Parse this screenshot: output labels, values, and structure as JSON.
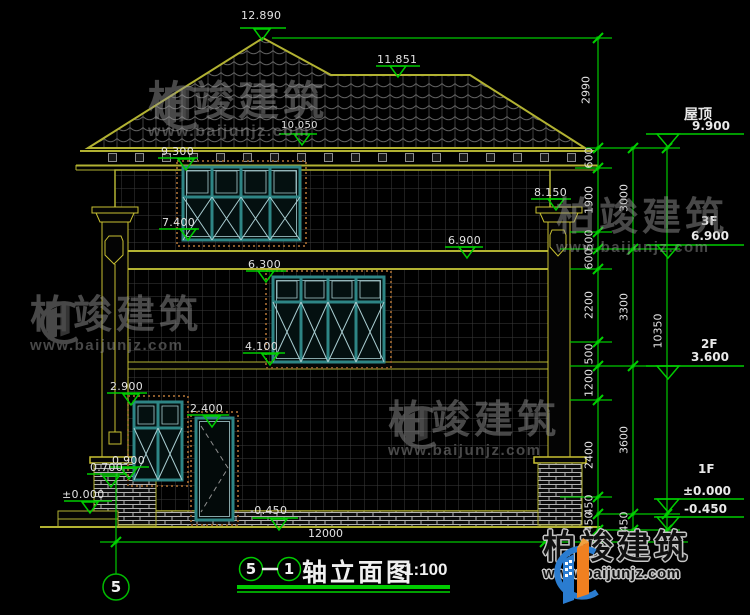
{
  "drawing": {
    "title": {
      "axis_start": "5",
      "axis_end": "1",
      "name": "轴立面图",
      "scale": "1:100"
    },
    "axis_bubble_label": "5",
    "elevation_markers": {
      "roof_peak": "12.890",
      "roof_ridge": "11.851",
      "eave_top": "10.050",
      "eave_bottom": "9.300",
      "column_top": "8.150",
      "f3_window_sill": "7.400",
      "f3_level": "6.900",
      "f3_slab_bottom": "6.300",
      "f2_window_sill": "4.100",
      "f1_window_top": "2.900",
      "door_top": "2.400",
      "f1_window_sill": "0.900",
      "pedestal_top": "0.700",
      "ground": "±0.000",
      "base": "-0.450"
    },
    "levels": [
      {
        "name": "屋顶",
        "elevation": "9.900"
      },
      {
        "name": "3F",
        "elevation": "6.900"
      },
      {
        "name": "2F",
        "elevation": "3.600"
      },
      {
        "name": "1F",
        "elevation": "±0.000",
        "elevation_below": "-0.450"
      }
    ],
    "dimensions": {
      "roof_height": "2990",
      "chain_detail": [
        "600",
        "1900",
        "500",
        "600",
        "2200",
        "500",
        "1200",
        "2400",
        "450",
        "450"
      ],
      "chain_floor": [
        "3000",
        "3300",
        "3600",
        "450"
      ],
      "chain_total": [
        "10350"
      ],
      "total_width": "12000"
    },
    "watermark": {
      "brand": "柏竣建筑",
      "site": "www.baijunjz.com"
    },
    "colors": {
      "line": "#b2b232",
      "dimension": "#00c800",
      "window_frame": "#2e8585",
      "background": "#000000",
      "logo_blue": "#2a7cd0",
      "logo_orange": "#f08020"
    }
  }
}
